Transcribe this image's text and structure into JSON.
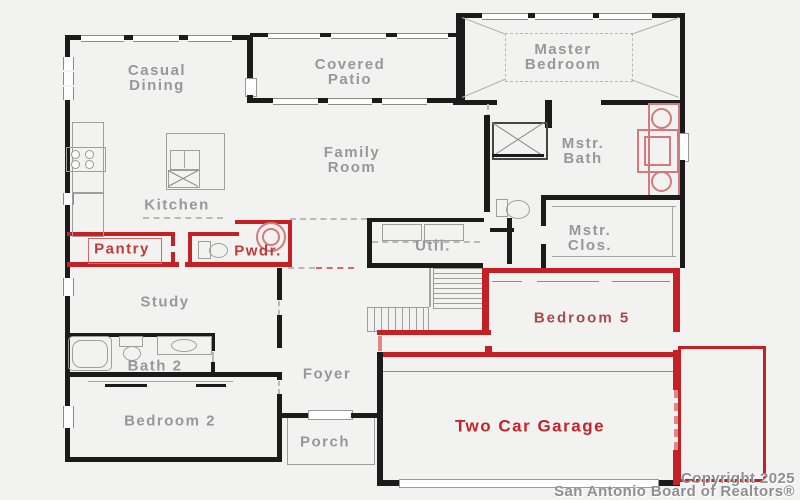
{
  "rooms": {
    "casual_dining": {
      "line1": "Casual",
      "line2": "Dining"
    },
    "covered_patio": {
      "line1": "Covered",
      "line2": "Patio"
    },
    "master_bedroom": {
      "line1": "Master",
      "line2": "Bedroom"
    },
    "family_room": {
      "line1": "Family",
      "line2": "Room"
    },
    "kitchen": {
      "line1": "Kitchen"
    },
    "mstr_bath": {
      "line1": "Mstr.",
      "line2": "Bath"
    },
    "mstr_clos": {
      "line1": "Mstr.",
      "line2": "Clos."
    },
    "pantry": {
      "line1": "Pantry"
    },
    "pwdr": {
      "line1": "Pwdr."
    },
    "util": {
      "line1": "Util."
    },
    "study": {
      "line1": "Study"
    },
    "bedroom5": {
      "line1": "Bedroom 5"
    },
    "bath2": {
      "line1": "Bath 2"
    },
    "foyer": {
      "line1": "Foyer"
    },
    "bedroom2": {
      "line1": "Bedroom 2"
    },
    "porch": {
      "line1": "Porch"
    },
    "garage": {
      "line1": "Two Car Garage"
    }
  },
  "copyright": {
    "line1": "Copyright 2025",
    "line2": "San Antonio Board of Realtors®"
  },
  "colors": {
    "wall": "#1b1b1b",
    "option_red": "#c42127",
    "fixture_pink": "#d4797d",
    "label_gray": "#97979c",
    "label_red": "#c03a36",
    "bedroom5_red": "#a9484d",
    "garage_red": "#c42328",
    "background": "#f2f2f1"
  }
}
